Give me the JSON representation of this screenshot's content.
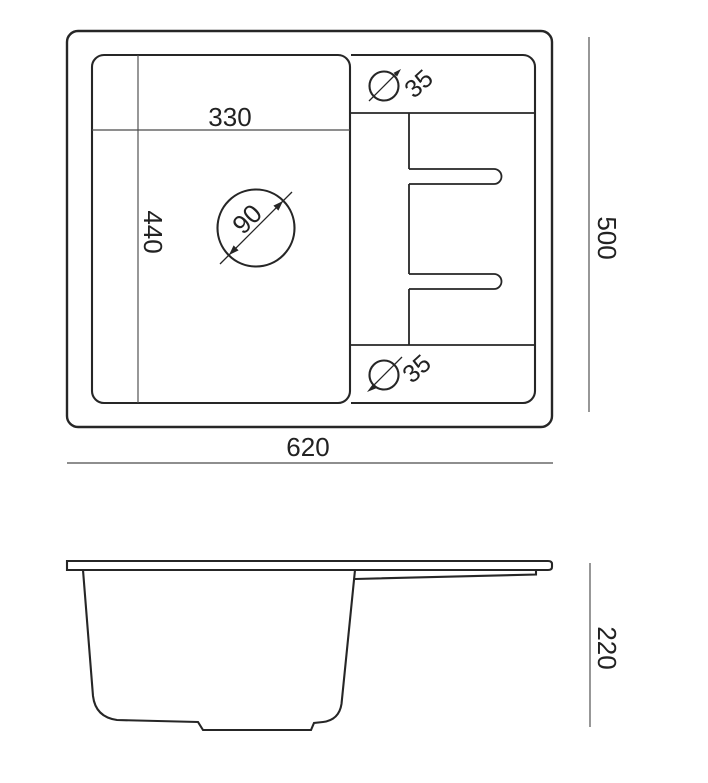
{
  "colors": {
    "background": "#ffffff",
    "line": "#262626",
    "dim": "#4b4b4b",
    "text": "#222222"
  },
  "top_view": {
    "bowl_width_mm": "330",
    "bowl_depth_mm": "440",
    "drain_hole_diameter_mm": "90",
    "tap_hole_top_diameter_mm": "35",
    "tap_hole_bottom_diameter_mm": "35",
    "overall_width_mm": "620",
    "overall_depth_mm": "500"
  },
  "side_view": {
    "overall_height_mm": "220"
  }
}
